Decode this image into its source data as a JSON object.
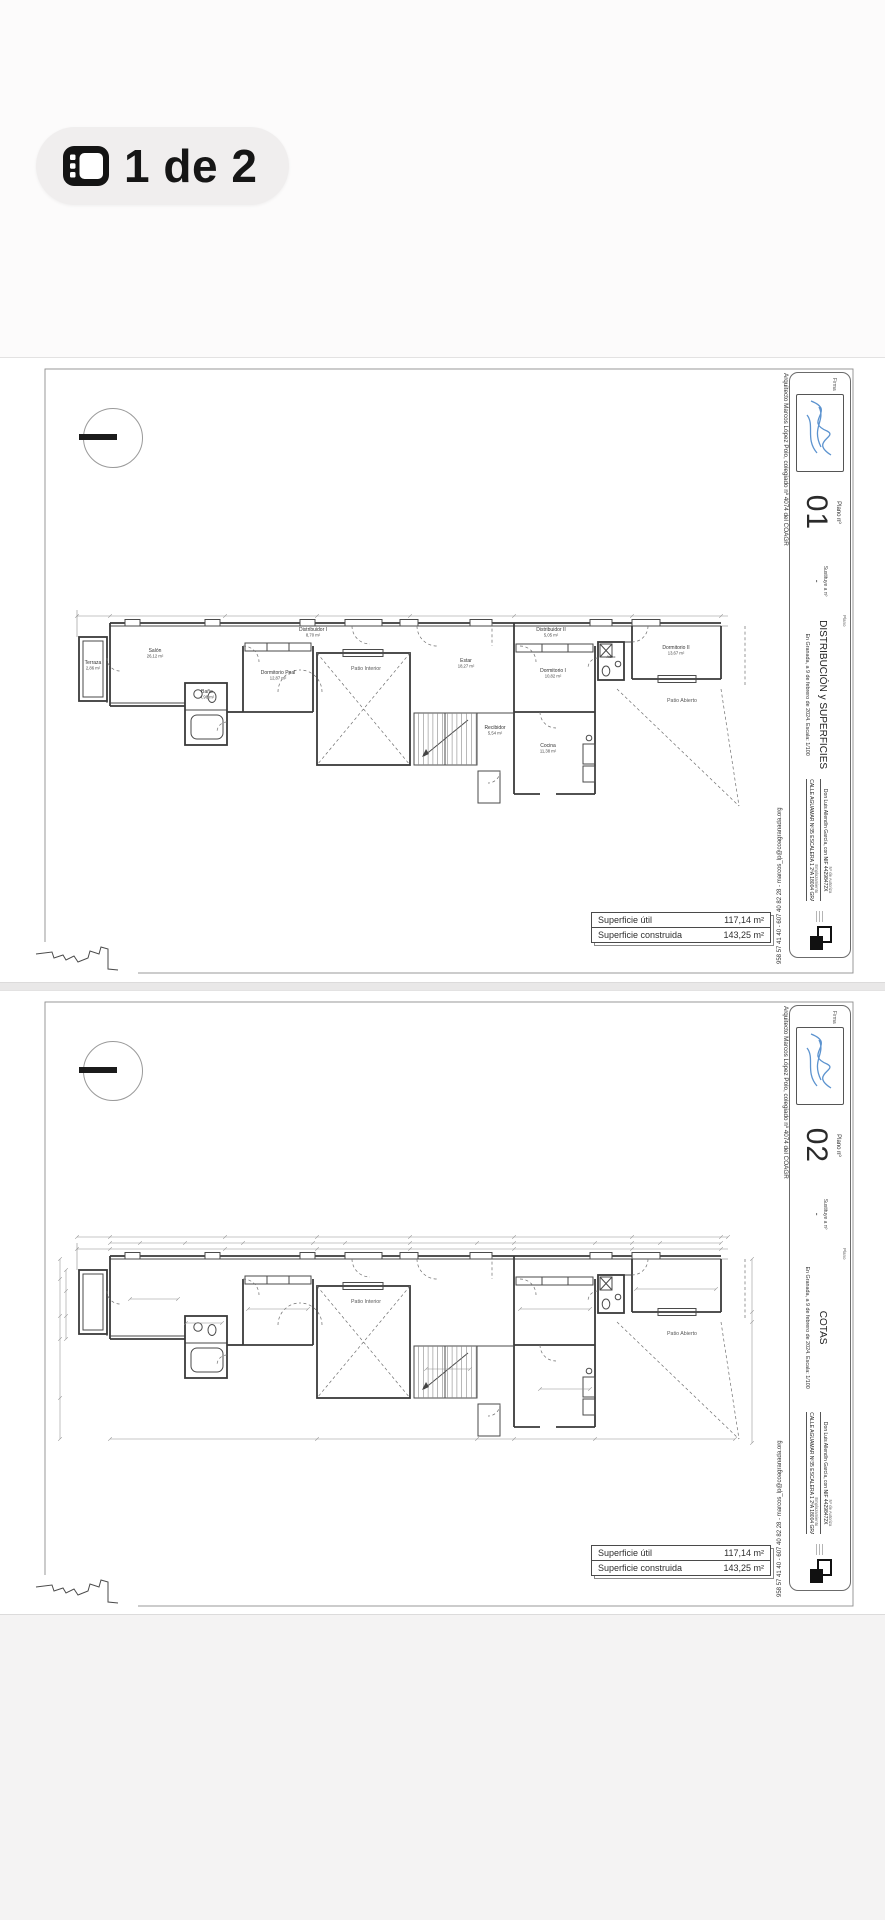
{
  "badge": {
    "counter_label": "1 de 2",
    "icon": "floorplan-gallery-icon"
  },
  "colors": {
    "paper": "#ffffff",
    "page_bg": "#fcfbfb",
    "ink": "#3a3a3a",
    "signature_blue": "#5c93cf",
    "badge_bg": "#f0eeee"
  },
  "title_block": {
    "architect_credit": "Arquitecto Marcos López Polo, colegiado nº 4074 del COAGR",
    "firma_label": "Firma",
    "plano_no_label": "Plano nº",
    "substitute_label": "Sustituye a nº",
    "substitute_value": "-",
    "plano_label": "Plano",
    "date_scale_line": "En Granada, a 9 de febrero de 2024. Escala: 1/100",
    "client_field_label": "Nº de Autoriza",
    "client_line": "Don Luis Allendín García, con NIF 44298472X",
    "location_label": "Emplazamiento",
    "location_line": "CALLE AGUAMAR Nº35 ESCALERA 1 2ºA 18004 GRANADA",
    "contact_line": "958 57 41 40 - 607 40 82 28 - marcos_lp@coagranada.org"
  },
  "sheets": [
    {
      "sheet_number": "01",
      "plan_title": "DISTRIBUCIÓN y SUPERFICIES"
    },
    {
      "sheet_number": "02",
      "plan_title": "COTAS"
    }
  ],
  "summary_table": {
    "rows": [
      {
        "label": "Superficie útil",
        "value": "117,14 m²"
      },
      {
        "label": "Superficie construida",
        "value": "143,25 m²"
      }
    ]
  },
  "rooms": {
    "terraza": {
      "name": "Terraza",
      "area": "2,86 m²"
    },
    "salon": {
      "name": "Salón",
      "area": "26,12 m²"
    },
    "bano": {
      "name": "Baño",
      "area": "4,98 m²"
    },
    "dorm_ppal": {
      "name": "Dormitorio Ppal",
      "area": "12,87 m²"
    },
    "dist1": {
      "name": "Distribuidor I",
      "area": "8,70 m²"
    },
    "estar": {
      "name": "Estar",
      "area": "18,27 m²"
    },
    "dist2": {
      "name": "Distribuidor II",
      "area": "5,05 m²"
    },
    "dorm1": {
      "name": "Dormitorio I",
      "area": "10,82 m²"
    },
    "aseo": {
      "name": "Aseo",
      "area": ""
    },
    "dorm2": {
      "name": "Dormitorio II",
      "area": "13,67 m²"
    },
    "recibidor": {
      "name": "Recibidor",
      "area": "5,54 m²"
    },
    "cocina": {
      "name": "Cocina",
      "area": "11,38 m²"
    },
    "patio_interior": {
      "name": "Patio Interior"
    },
    "patio_abierto": {
      "name": "Patio Abierto"
    }
  }
}
